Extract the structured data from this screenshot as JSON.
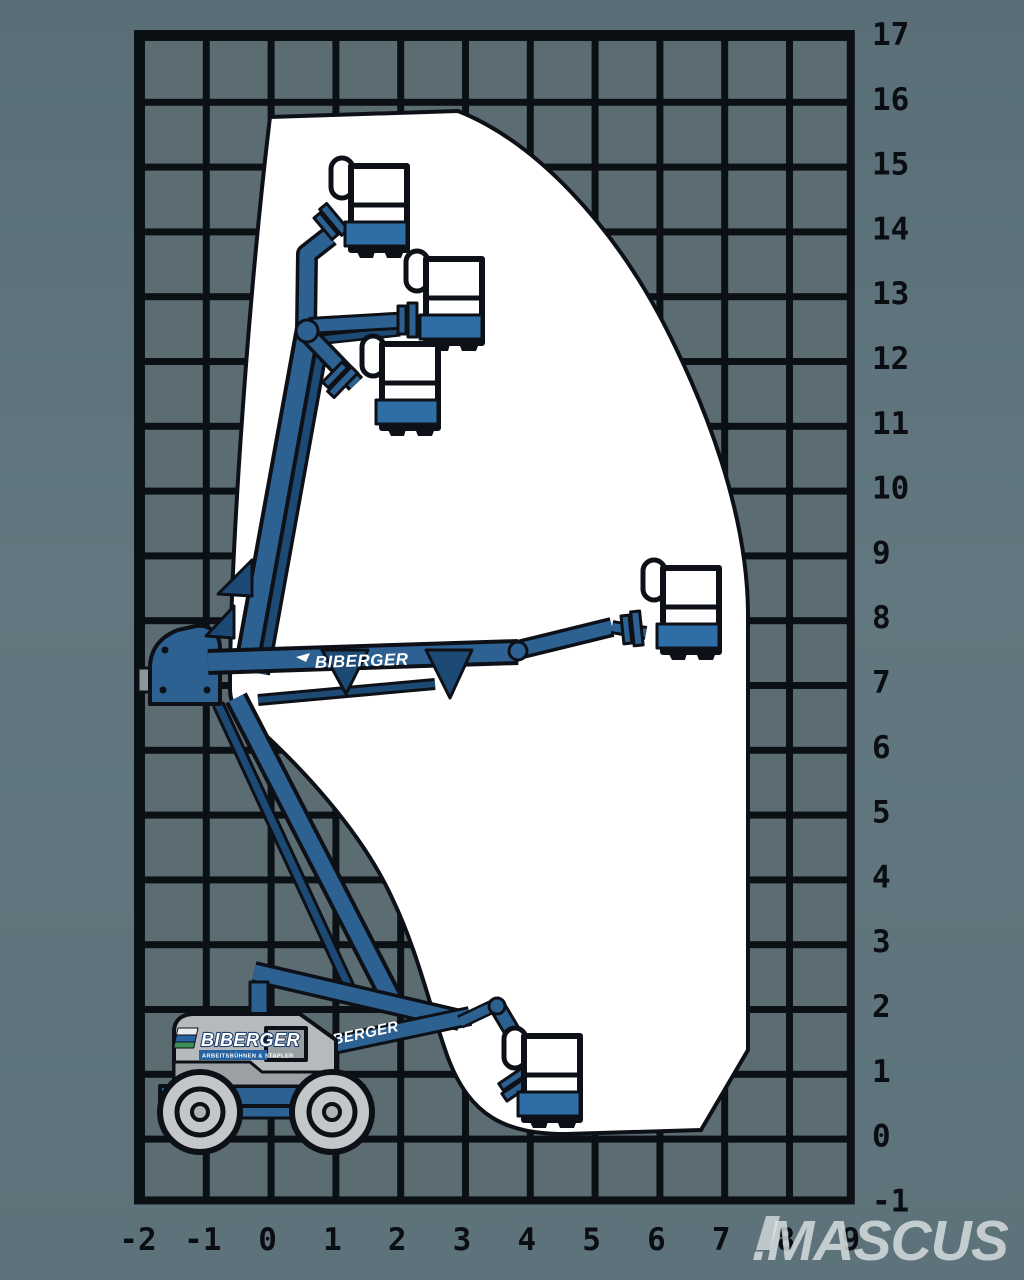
{
  "brand": {
    "name": "BIBERGER",
    "tagline": "ARBEITSBÜHNEN & STAPLER"
  },
  "watermark": {
    "text": ".MASCUS"
  },
  "axes": {
    "unit": "m",
    "right": {
      "labels": [
        "17",
        "16",
        "15",
        "14",
        "13",
        "12",
        "11",
        "10",
        "9",
        "8",
        "7",
        "6",
        "5",
        "4",
        "3",
        "2",
        "1",
        "0",
        "-1"
      ]
    },
    "bottom": {
      "labels": [
        "-2",
        "-1",
        "0",
        "1",
        "2",
        "3",
        "4",
        "5",
        "6",
        "7",
        "8",
        "9"
      ]
    }
  },
  "colors": {
    "background": "#5f757c",
    "grid_cell": "#5b6c73",
    "grid_line": "#0b1014",
    "envelope": "#ffffff",
    "machine_blue": "#2d6191",
    "machine_blue_dark": "#1d4a74",
    "basket_band_blue": "#2e6da6",
    "chassis_gray": "#b6babc",
    "chassis_gray_dark": "#9ba1a4",
    "outline": "#0d1117",
    "label": "#0a0e12",
    "watermark": "#dde4e6",
    "stripe_blue": "#2563a3",
    "emblem_green": "#3c8f55"
  },
  "chart_data": {
    "type": "area",
    "title": "Articulated boom lift working envelope (BIBERGER)",
    "xlabel": "outreach (m)",
    "ylabel": "height (m)",
    "xlim": [
      -2,
      9
    ],
    "ylim": [
      -1,
      17
    ],
    "grid": "1 m squares",
    "envelope_points_m": [
      [
        0.0,
        15.7
      ],
      [
        2.9,
        15.8
      ],
      [
        6.1,
        12.5
      ],
      [
        7.4,
        8.1
      ],
      [
        7.4,
        1.3
      ],
      [
        6.7,
        0.1
      ],
      [
        4.6,
        0.0
      ],
      [
        2.8,
        1.2
      ],
      [
        1.9,
        3.7
      ],
      [
        -0.4,
        6.5
      ],
      [
        -0.6,
        8.9
      ]
    ],
    "max_platform_height_m": 15.8,
    "max_outreach_m": 7.4,
    "platform_positions_shown": 5
  }
}
